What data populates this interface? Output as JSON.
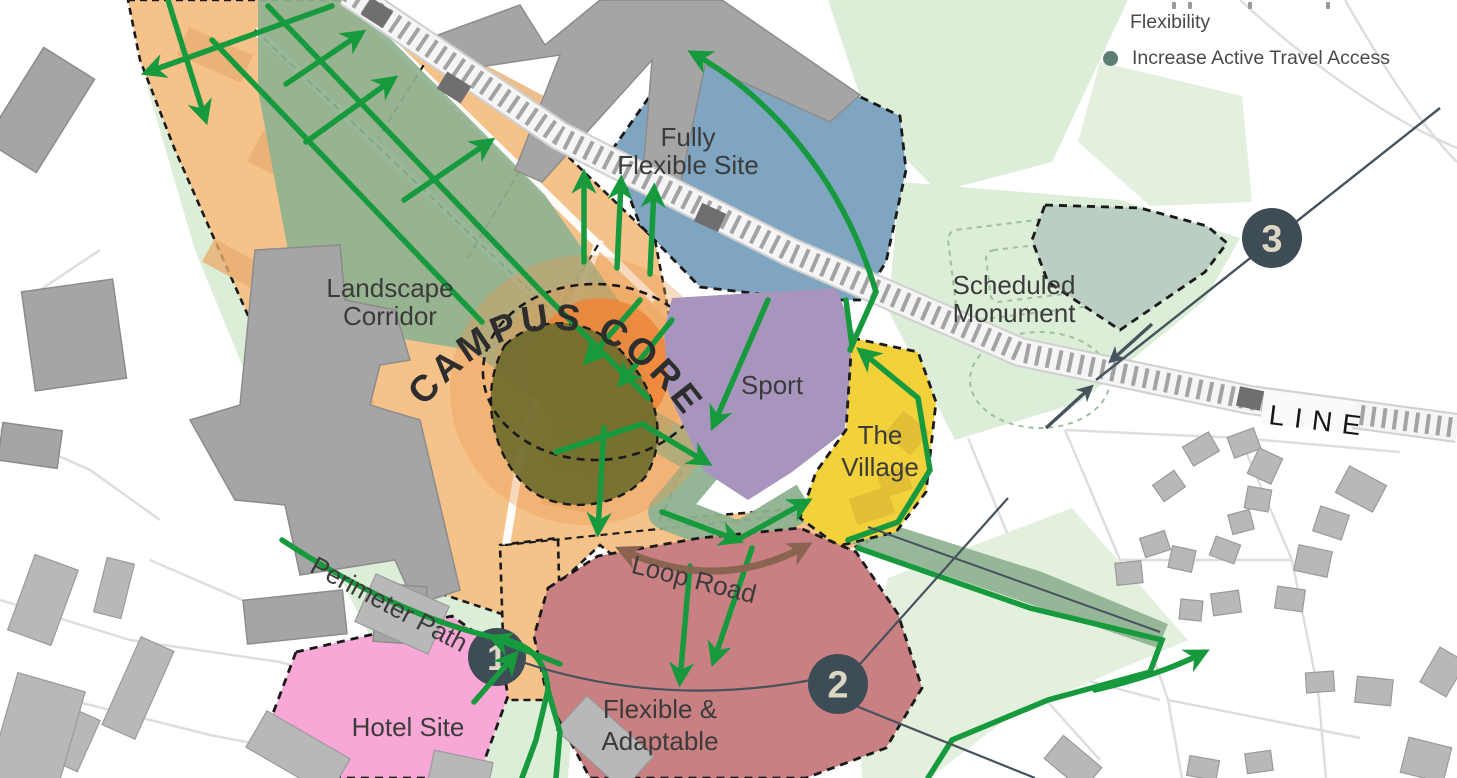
{
  "palette": {
    "orange": "#F5C28A",
    "orange-building": "#E9AE72",
    "core-outer": "#EC9A50",
    "core-inner": "#ED8637",
    "olive": "#6F6C2D",
    "sage": "#8EB290",
    "sage-monument": "#BACFC1",
    "green-light": "#DCEDD8",
    "green-field": "#E3F0DE",
    "blue": "#7FA5C1",
    "purple": "#A795BE",
    "yellow": "#F3D13B",
    "yellow-building": "#E0BC35",
    "pink": "#F8A8D7",
    "red": "#C98082",
    "green-path": "#179A3E",
    "brown": "#8A6351",
    "slate": "#46525C",
    "circle-fill": "#3E4C56",
    "cream": "#DCD7C4",
    "text": "#3B3B3B",
    "rail-text": "#161616",
    "gray-building": "#A5A5A5",
    "house": "#B8B8B8",
    "road": "#DEDEDE",
    "legend-bullet": "#5E7D73",
    "legend-text": "#4A4A4A"
  },
  "legend": {
    "item_flexibility": {
      "label": "Flexibility"
    },
    "item_active_travel": {
      "label": "Increase Active Travel Access"
    }
  },
  "map": {
    "labels": {
      "fully_flexible_line1": "Fully",
      "fully_flexible_line2": "Flexible Site",
      "scheduled_monument_line1": "Scheduled",
      "scheduled_monument_line2": "Monument",
      "landscape_corridor_line1": "Landscape",
      "landscape_corridor_line2": "Corridor",
      "campus_core": "CAMPUS CORE",
      "sport": "Sport",
      "village_line1": "The",
      "village_line2": "Village",
      "loop_road": "Loop Road",
      "perimeter_path": "Perimeter Path",
      "hotel": "Hotel Site",
      "flexible_line1": "Flexible &",
      "flexible_line2": "Adaptable",
      "railway": "LINE"
    },
    "markers": {
      "m1": "1",
      "m2": "2",
      "m3": "3"
    }
  }
}
